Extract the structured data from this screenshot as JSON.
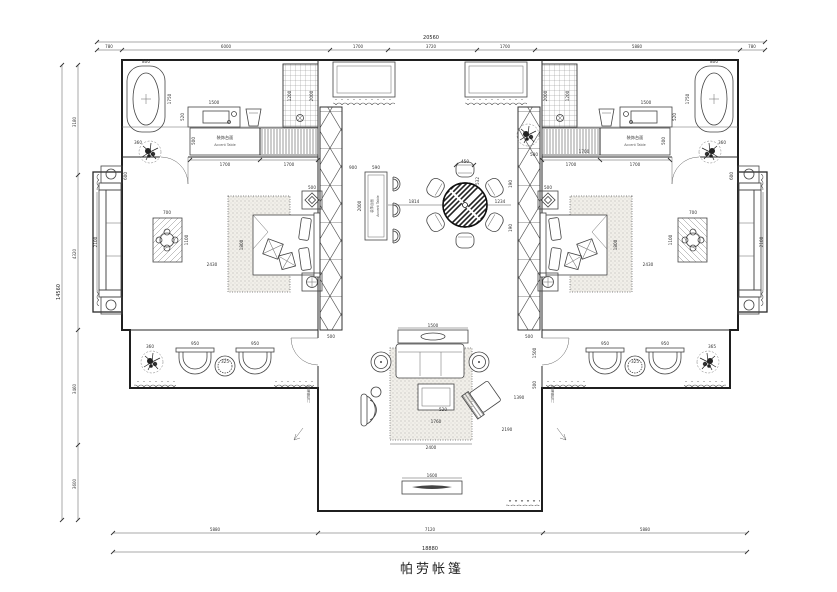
{
  "title": "帕劳帐篷",
  "dim_top": {
    "total": "20560",
    "s1": "780",
    "s2": "6000",
    "s3": "1700",
    "s4": "3720",
    "s5": "1700",
    "s6": "5880",
    "s7": "780"
  },
  "dim_left": {
    "total": "14560",
    "s1": "3180",
    "s2": "4320",
    "s3": "3460",
    "s4": "3600"
  },
  "dim_bottom": {
    "total": "18880",
    "s1": "5880",
    "s2": "7120",
    "s3": "5880"
  },
  "rooms": {
    "accent_table_cn": "装饰台面",
    "accent_table_en": "Accent Table",
    "door_note": "玻璃推拉门"
  },
  "annot": {
    "tub_w": "800",
    "tub_len": "1750",
    "vanity_w": "1500",
    "vanity_d": "520",
    "shower_w": "1200",
    "shower_h": "2000",
    "accent_span1": "1700",
    "accent_span2": "1700",
    "accent_d": "500",
    "plant_bath": "360",
    "coffee_w": "700",
    "coffee_h": "1100",
    "bed_gap": "2430",
    "bed_w": "1800",
    "nightstand": "500",
    "porch_sofa": "2100",
    "porch_table": "600",
    "bar_off": "900",
    "bar_w": "590",
    "bar_len": "2000",
    "lattice_w": "500",
    "dining_left": "1814",
    "dining_right": "1234",
    "chair_w": "450",
    "chair_d": "532",
    "niche_seg1": "190",
    "niche_seg2": "190",
    "niche_w": "500",
    "bedroom_door": "1700",
    "console_w": "1500",
    "rug_w": "2400",
    "rug_diag": "2190",
    "coffee2_w": "1760",
    "coffee2_d": "520",
    "chair_gap": "1390",
    "tv_w": "1600",
    "wing_chair1": "950",
    "wing_chair2": "950",
    "wing_table": "325",
    "wing_plant": "360",
    "wing_plant_r": "365",
    "wing_h1": "1500",
    "wing_h2": "500"
  }
}
